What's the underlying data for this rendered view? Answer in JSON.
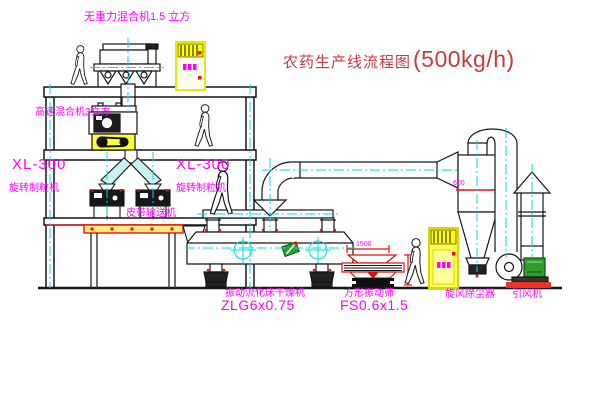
{
  "title": {
    "name_cn": "农药生产线流程图",
    "capacity": "(500kg/h)"
  },
  "equipment_labels": {
    "gravity_free_mixer": "无重力混合机1.5 立方",
    "high_speed_mixer": "高速混合机3立方",
    "granulator_left": {
      "model": "XL-300",
      "name": "旋转制粒机"
    },
    "granulator_center": {
      "model": "XL-300",
      "name": "旋转制粒机"
    },
    "belt_conveyor": "皮带输送机",
    "fluid_bed_dryer": {
      "name": "振动流化床干燥机",
      "model": "ZLG6x0.75"
    },
    "square_sieve": {
      "name": "方形振动筛",
      "model": "FS0.6x1.5"
    },
    "cyclone": "旋风除尘器",
    "induced_draft_fan": "引风机"
  },
  "dimensions": {
    "cyclone_width": "600",
    "sieve_length": "1500"
  },
  "colors": {
    "label_magenta": "#ff00ff",
    "title_red": "#c43c3c",
    "line_black": "#151515",
    "centerline_cyan": "#00dcdc",
    "accent_red": "#ee1111",
    "cabinet_yellow": "#ffff00",
    "motor_green": "#2f9e2f",
    "chute_teal": "#c9f2f2"
  }
}
